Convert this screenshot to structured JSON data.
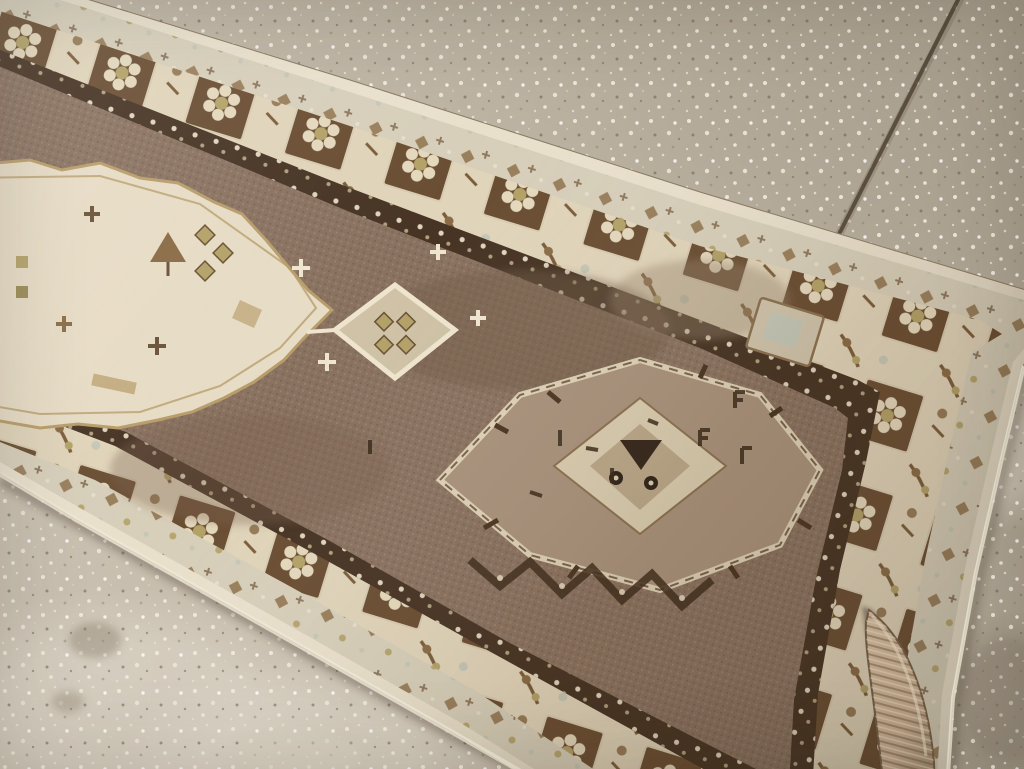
{
  "scene": {
    "type": "photograph",
    "subject": "Vintage handmade runner rug laid diagonally on a speckled concrete floor",
    "floor": "light speckled concrete with a diagonal expansion-joint seam at the upper right",
    "rug": "earth-tone runner: brown field, serrated ivory medallion at left, hooked diamond medallion at center, ivory floral borders, curled corner flap at lower right"
  },
  "palette": {
    "floor_base": "#c3b9a8",
    "floor_light": "#d6cec0",
    "floor_dark": "#a89d8b",
    "speck_light": "#f1ebdd",
    "speck_dark": "#5f564a",
    "seam": "#4e4336",
    "selvage": "#e9e0cc",
    "guard_band": "#d7cfba",
    "border_ivory": "#e0d4ba",
    "border_box_brown": "#6a4e33",
    "rosette_cream": "#e4d8bd",
    "dark_guard": "#473424",
    "guard_dot": "#e6dcc6",
    "field_brown": "#8a7260",
    "field_deep": "#6f5a47",
    "medallion_ivory": "#e7dcc5",
    "medallion_outline": "#b89d6a",
    "pendant_cream": "#cfc2a6",
    "khaki": "#b3a268",
    "tan": "#c4ad82",
    "pale_green": "#c2c6b6",
    "med2_body": "#a8917b",
    "med2_inner": "#d8cbae",
    "med2_core": "#b9a688",
    "dark_motif": "#3a2a1a",
    "flap_tan": "#b29a80",
    "flap_shadow": "#6b5741"
  }
}
